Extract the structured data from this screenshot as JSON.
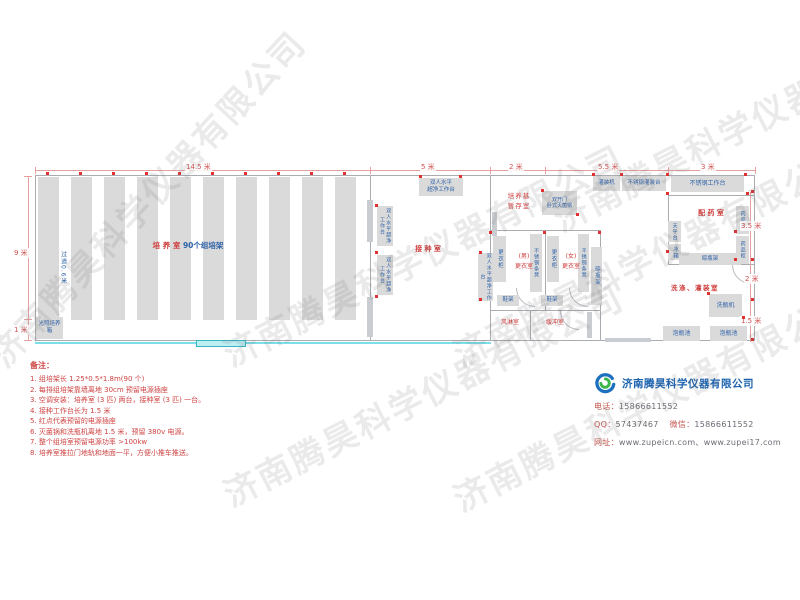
{
  "watermark": "济南腾昊科学仪器有限公司",
  "dims": {
    "top_culture": "14.5 米",
    "top_inoculation": "5 米",
    "top_storage": "2 米",
    "top_filling": "5.5 米",
    "top_worktable": "3 米",
    "left_main": "9 米",
    "left_bottom": "1 米",
    "right_top": "3.5 米",
    "right_mid": "2 米",
    "right_bottom": "1.5 米"
  },
  "rooms": {
    "culture": {
      "name": "培 养 室",
      "racks": "90个组培架",
      "aisle": "过道0.6米",
      "incubator": "光照培养箱"
    },
    "inoculation": {
      "name": "接 种 室",
      "bench_line1": "双人水平",
      "bench_line2": "超净工作台",
      "bench_vertical": "双人水平超净工作台"
    },
    "storage": {
      "line1": "培养基",
      "line2": "暂存室"
    },
    "sterilizer": {
      "line1": "双开门",
      "line2": "卧式灭菌锅"
    },
    "male": {
      "line1": "(男)",
      "line2": "更衣室",
      "locker": "更衣柜",
      "bench": "不锈钢条凳",
      "shoe": "鞋架"
    },
    "female": {
      "line1": "(女)",
      "line2": "更衣室",
      "locker": "更衣柜",
      "bench": "不锈钢条凳",
      "shoe": "鞋架",
      "rack": "晾瓶架"
    },
    "air_shower": "风淋室",
    "buffer": "缓冲室",
    "washing": {
      "name": "洗涤、灌装室",
      "washer": "洗瓶机",
      "pool": "泡瓶池"
    },
    "pharmacy": {
      "name": "配 药 室",
      "worktable": "不锈钢工作台",
      "cabinet": "药品柜",
      "balance": "天平台",
      "fridge": "冰箱",
      "rack": "晾瓶架"
    },
    "filling": {
      "machine": "灌装机",
      "table": "不锈钢灌装台"
    }
  },
  "notes": {
    "title": "备注：",
    "items": [
      "1. 组培架长 1.25*0.5*1.8m(90 个)",
      "2. 每排组培架靠墙离地 30cm 预留电源插座",
      "3. 空调安装：培养室 (3 匹) 两台，接种室 (3 匹) 一台。",
      "4. 接种工作台长为 1.5 米",
      "5. 红点代表预留的电源插座",
      "6. 灭菌锅和洗瓶机离地 1.5 米，预留 380v 电源。",
      "7. 整个组培室预留电源功率 >100kw",
      "8. 培养室推拉门地轨和地面一平，方便小推车推送。"
    ]
  },
  "company": {
    "name": "济南腾昊科学仪器有限公司",
    "phone_label": "电话：",
    "phone": "15866611552",
    "qq_label": "QQ：",
    "qq": "57437467",
    "wechat_label": "微信：",
    "wechat": "15866611552",
    "web_label": "网址：",
    "web": "www.zupeicn.com、www.zupei17.com"
  },
  "colors": {
    "room_label_red": "#cf3a3a",
    "equipment_label_blue": "#2e62a8",
    "company_blue": "#1b62ae",
    "outlet_red": "#e03030",
    "door_cyan": "#7adfe8"
  }
}
